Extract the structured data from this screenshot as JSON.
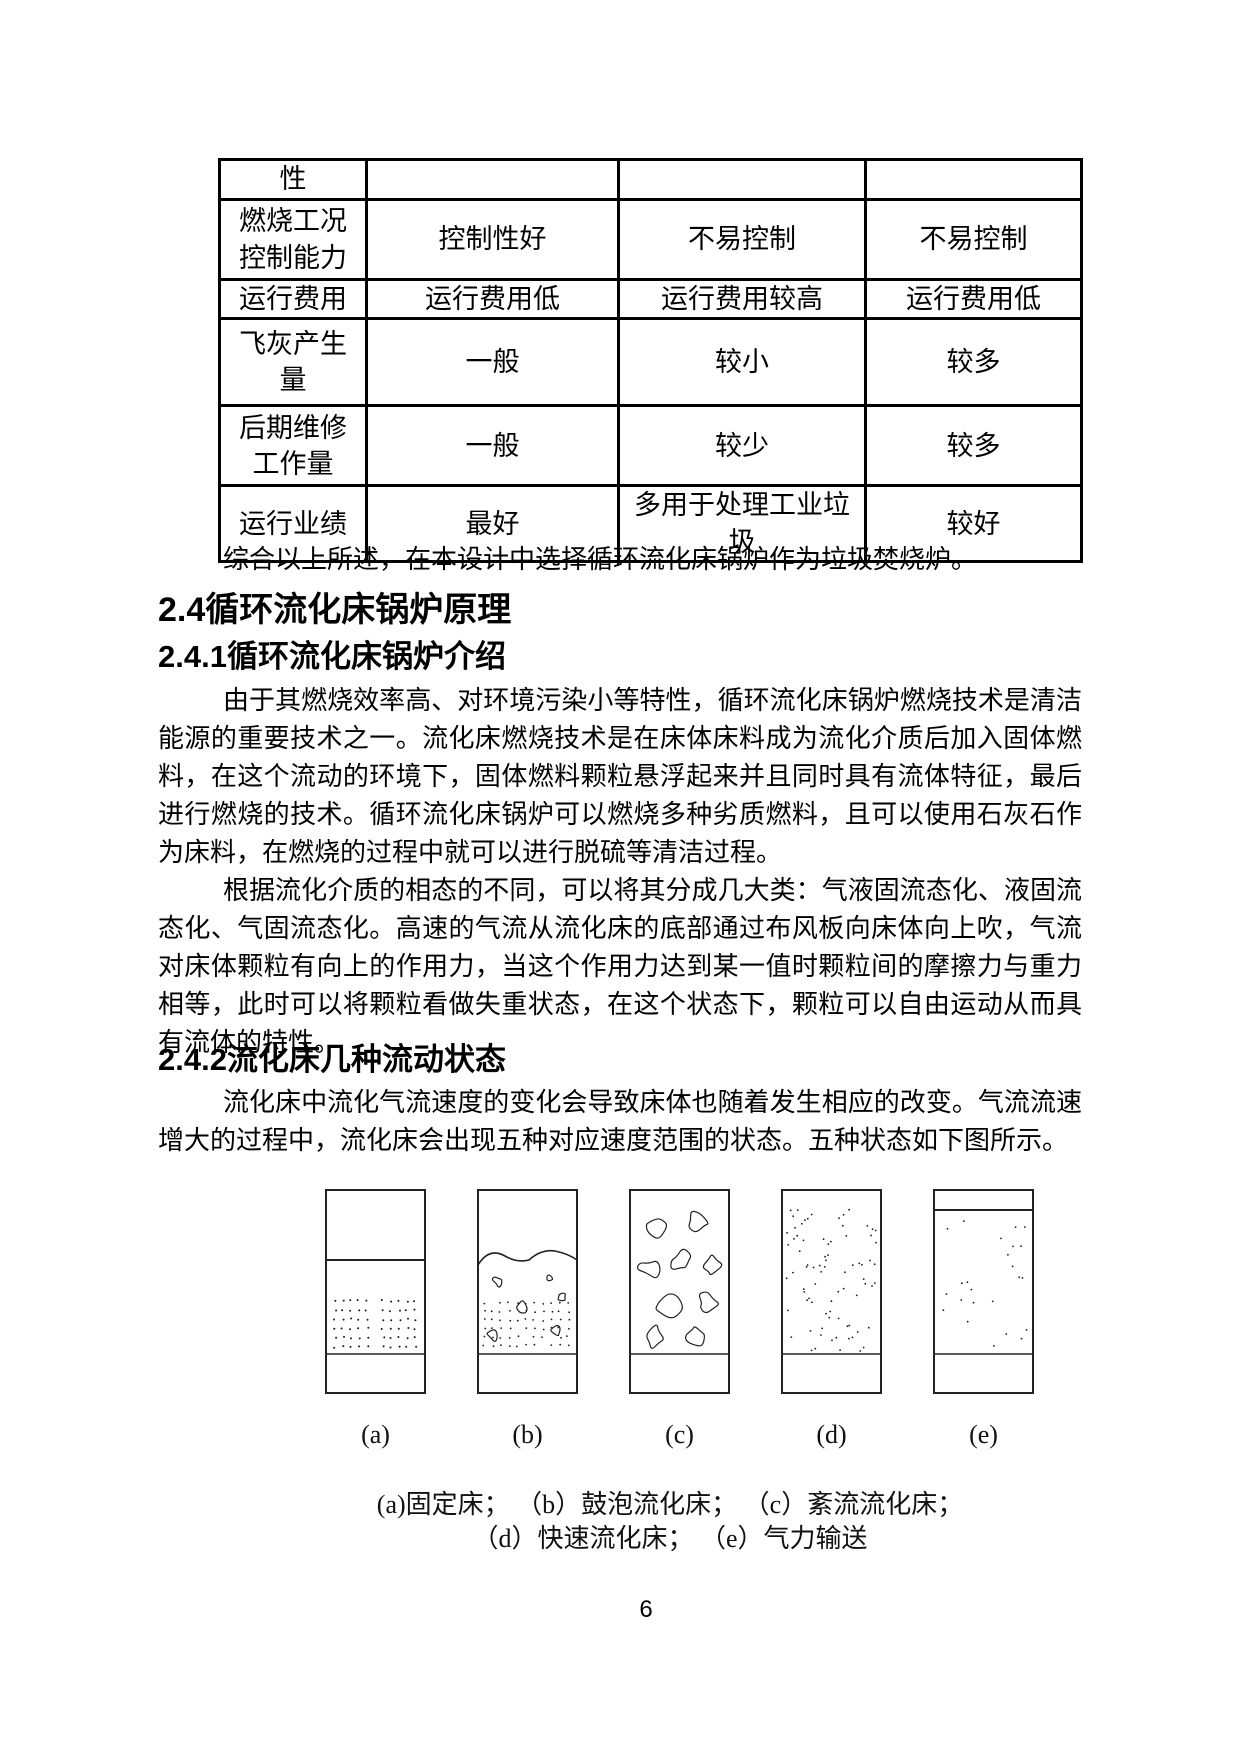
{
  "page": {
    "number": "6"
  },
  "table": {
    "rows": [
      {
        "cells": [
          "性",
          "",
          "",
          ""
        ]
      },
      {
        "cells": [
          "燃烧工况控制能力",
          "控制性好",
          "不易控制",
          "不易控制"
        ]
      },
      {
        "cells": [
          "运行费用",
          "运行费用低",
          "运行费用较高",
          "运行费用低"
        ]
      },
      {
        "cells": [
          "飞灰产生量",
          "一般",
          "较小",
          "较多"
        ]
      },
      {
        "cells": [
          "后期维修工作量",
          "一般",
          "较少",
          "较多"
        ]
      },
      {
        "cells": [
          "运行业绩",
          "最好",
          "多用于处理工业垃圾",
          "较好"
        ]
      }
    ]
  },
  "content": {
    "summary_line": "综合以上所述，在本设计中选择循环流化床锅炉作为垃圾焚烧炉。",
    "heading_2_4": "2.4循环流化床锅炉原理",
    "heading_2_4_1": "2.4.1循环流化床锅炉介绍",
    "para_intro_1": "由于其燃烧效率高、对环境污染小等特性，循环流化床锅炉燃烧技术是清洁能源的重要技术之一。流化床燃烧技术是在床体床料成为流化介质后加入固体燃料，在这个流动的环境下，固体燃料颗粒悬浮起来并且同时具有流体特征，最后进行燃烧的技术。循环流化床锅炉可以燃烧多种劣质燃料，且可以使用石灰石作为床料，在燃烧的过程中就可以进行脱硫等清洁过程。",
    "para_intro_2": "根据流化介质的相态的不同，可以将其分成几大类：气液固流态化、液固流态化、气固流态化。高速的气流从流化床的底部通过布风板向床体向上吹，气流对床体颗粒有向上的作用力，当这个作用力达到某一值时颗粒间的摩擦力与重力相等，此时可以将颗粒看做失重状态，在这个状态下，颗粒可以自由运动从而具有流体的特性。",
    "heading_2_4_2": "2.4.2流化床几种流动状态",
    "para_states": "流化床中流化气流速度的变化会导致床体也随着发生相应的改变。气流流速增大的过程中，流化床会出现五种对应速度范围的状态。五种状态如下图所示。"
  },
  "figure": {
    "panels": [
      {
        "label": "(a)",
        "type": "fixed-bed"
      },
      {
        "label": "(b)",
        "type": "bubbling"
      },
      {
        "label": "(c)",
        "type": "turbulent"
      },
      {
        "label": "(d)",
        "type": "fast"
      },
      {
        "label": "(e)",
        "type": "pneumatic"
      }
    ],
    "caption_line1": "(a)固定床； （b）鼓泡流化床； （c）紊流流化床；",
    "caption_line2": "（d）快速流化床； （e）气力输送"
  }
}
